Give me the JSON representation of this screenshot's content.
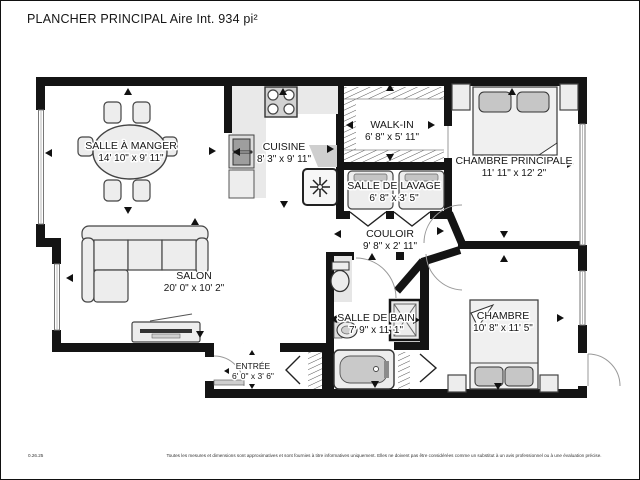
{
  "header": {
    "title": "PLANCHER PRINCIPAL Aire Int. 934 pi²"
  },
  "rooms": {
    "dining": {
      "name": "SALLE À MANGER",
      "dims": "14' 10\" x 9' 11\""
    },
    "kitchen": {
      "name": "CUISINE",
      "dims": "8' 3\" x 9' 11\""
    },
    "walkin": {
      "name": "WALK-IN",
      "dims": "6' 8\" x 5' 11\""
    },
    "master": {
      "name": "CHAMBRE PRINCIPALE",
      "dims": "11' 11\" x 12' 2\""
    },
    "laundry": {
      "name": "SALLE DE LAVAGE",
      "dims": "6' 8\" x 3' 5\""
    },
    "hall": {
      "name": "COULOIR",
      "dims": "9' 8\" x 2' 11\""
    },
    "living": {
      "name": "SALON",
      "dims": "20' 0\" x 10' 2\""
    },
    "bath": {
      "name": "SALLE DE BAIN",
      "dims": "7' 9\" x 11' 1\""
    },
    "bedroom": {
      "name": "CHAMBRE",
      "dims": "10' 8\" x 11' 5\""
    },
    "entry": {
      "name": "ENTRÉE",
      "dims": "6' 0\" x 3' 6\""
    }
  },
  "footer": {
    "date": "0.26.25",
    "disclaimer": "Toutes les mesures et dimensions sont approximatives et sont fournies à titre informatives uniquement. Elles ne doivent pas être considérées comme un substitut à un avis professionnel ou à une évaluation précise."
  },
  "colors": {
    "wall": "#141414",
    "furniture": "#ededed",
    "shade": "#c6c6c6"
  }
}
